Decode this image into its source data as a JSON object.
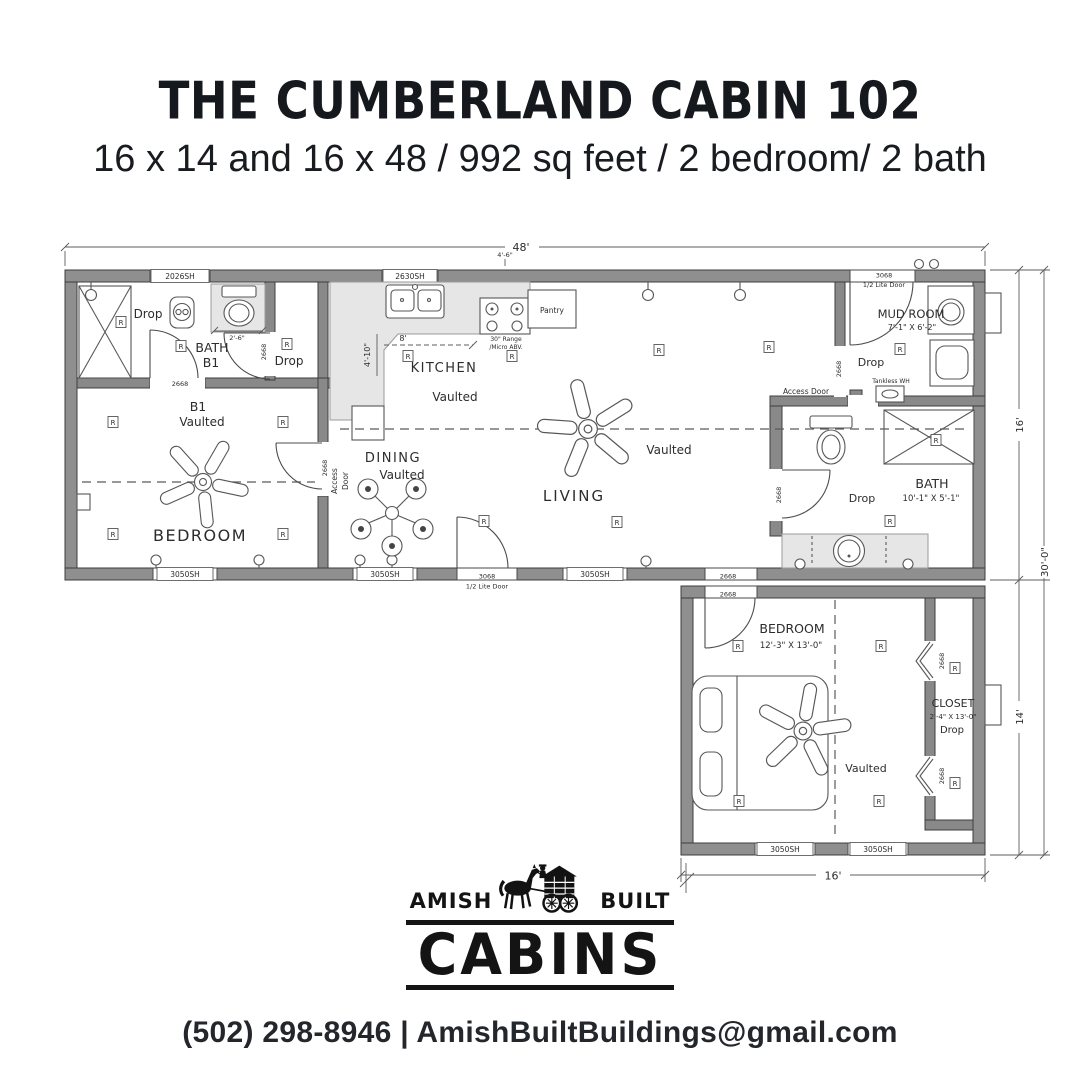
{
  "page": {
    "title": "THE CUMBERLAND CABIN 102",
    "subtitle": "16 x 14 and 16 x 48 / 992 sq feet / 2 bedroom/ 2 bath",
    "contact": "(502) 298-8946 | AmishBuiltBuildings@gmail.com"
  },
  "logo": {
    "left": "AMISH",
    "right": "BUILT",
    "name": "CABINS"
  },
  "plan": {
    "dims": {
      "top": "48'",
      "right_upper": "16'",
      "right_total": "30'-0\"",
      "right_lower": "14'",
      "bottom": "16'",
      "kitchen_depth": "4'-10\"",
      "kitchen_run": "8'",
      "bath_alcove": "2'-6\"",
      "top_small": "4'-6\""
    },
    "rooms": {
      "bath1_name": "BATH",
      "bath1_num": "B1",
      "b1_name": "B1",
      "b1_vaulted": "Vaulted",
      "bedroom1": "BEDROOM",
      "kitchen": "KITCHEN",
      "kitchen_vaulted": "Vaulted",
      "dining": "DINING",
      "dining_vaulted": "Vaulted",
      "living": "LIVING",
      "living_vaulted": "Vaulted",
      "mudroom": "MUD ROOM",
      "mudroom_size": "7'-1\" X 6'-2\"",
      "bath2": "BATH",
      "bath2_size": "10'-1\" X 5'-1\"",
      "bedroom2": "BEDROOM",
      "bedroom2_size": "12'-3\" X 13'-0\"",
      "bedroom2_vaulted": "Vaulted",
      "closet": "CLOSET",
      "closet_size": "2'-4\" X 13'-0\"",
      "closet_drop": "Drop"
    },
    "labels": {
      "drop": "Drop",
      "r": "R",
      "access_door": "Access Door",
      "access_1": "Access",
      "access_2": "Door",
      "pantry": "Pantry",
      "range_1": "30\" Range",
      "range_2": "/Micro ABV.",
      "tankless": "Tankless WH",
      "w2026": "2026SH",
      "w2630": "2630SH",
      "w3050": "3050SH",
      "d3068": "3068",
      "d3068b": "1/2 Lite Door",
      "d2668": "2668"
    }
  }
}
